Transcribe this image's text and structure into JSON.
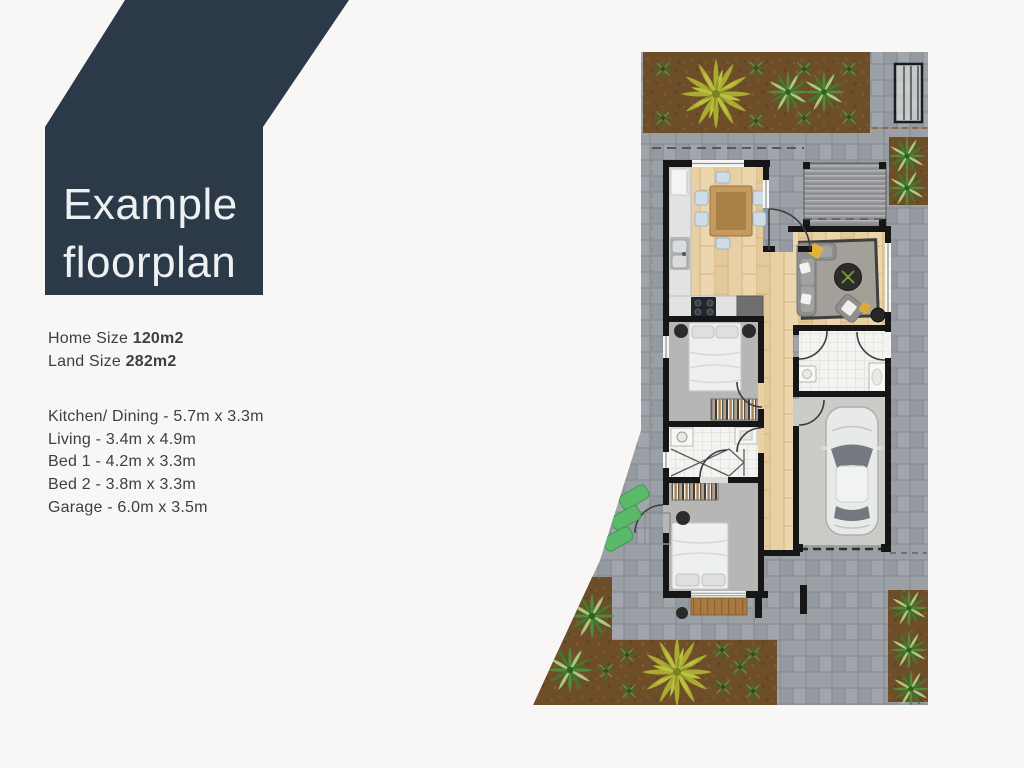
{
  "banner": {
    "line1": "Example",
    "line2": "floorplan",
    "bg_color": "#2b3949",
    "text_color": "#eef0f1"
  },
  "page_bg": "#f8f7f5",
  "stats": [
    {
      "label": "Home Size",
      "value": "120m2"
    },
    {
      "label": "Land Size",
      "value": "282m2"
    }
  ],
  "rooms": [
    {
      "text": "Kitchen/ Dining - 5.7m x 3.3m"
    },
    {
      "text": "Living - 3.4m x 4.9m"
    },
    {
      "text": "Bed 1 - 4.2m x 3.3m"
    },
    {
      "text": "Bed 2 - 3.8m x 3.3m"
    },
    {
      "text": "Garage - 6.0m x 3.5m"
    }
  ],
  "floorplan_colors": {
    "pavers": "#9aa0a5",
    "garden_soil": "#6e4d29",
    "wood_floor": "#e8d0a4",
    "carpet": "#b6b6b4",
    "tile": "#f3f3f1",
    "wall": "#161616",
    "pergola": "#97989b",
    "garage_concrete": "#cbcbc7",
    "plant_green": "#4f8c3b",
    "bush_yellow": "#a9ac31",
    "stepping_pads": "#5bb969",
    "deck_wood": "#a87a42",
    "car_body": "#e8e9e9"
  }
}
